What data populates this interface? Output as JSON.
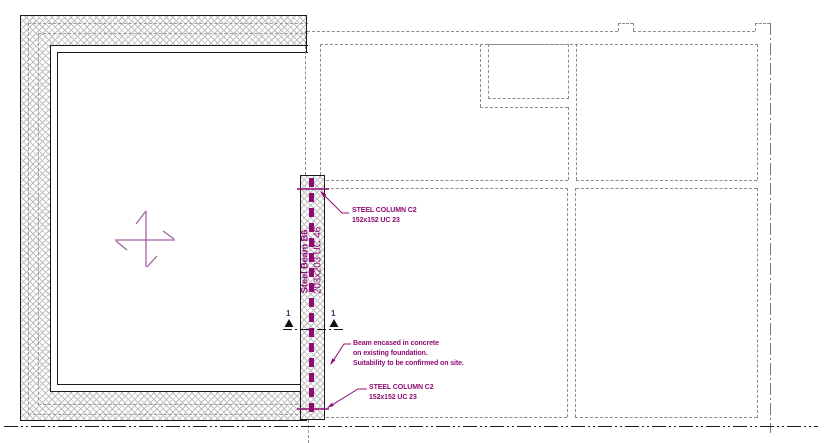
{
  "drawing": {
    "title": "steel-beam-floor-plan",
    "beam_label": {
      "name": "Steel Beam B6",
      "size": "203x203 UC 46"
    },
    "notes": {
      "column_top": {
        "line1": "STEEL COLUMN C2",
        "line2": "152x152 UC 23"
      },
      "column_bottom": {
        "line1": "STEEL COLUMN C2",
        "line2": "152x152 UC 23"
      },
      "encased": {
        "line1": "Beam encased in concrete",
        "line2": "on existing foundation.",
        "line3": "Suitability to be confirmed on site."
      }
    },
    "section_markers": {
      "left_label": "1",
      "right_label": "1"
    },
    "colors": {
      "annotation_magenta": "#8f0b74",
      "cross_purple": "#a263a0",
      "dashed_gray": "#8c8c8c",
      "solid_black": "#1a1a1a",
      "section_label_navy": "#23406b",
      "hatch_gray": "#bfbfbf"
    }
  }
}
